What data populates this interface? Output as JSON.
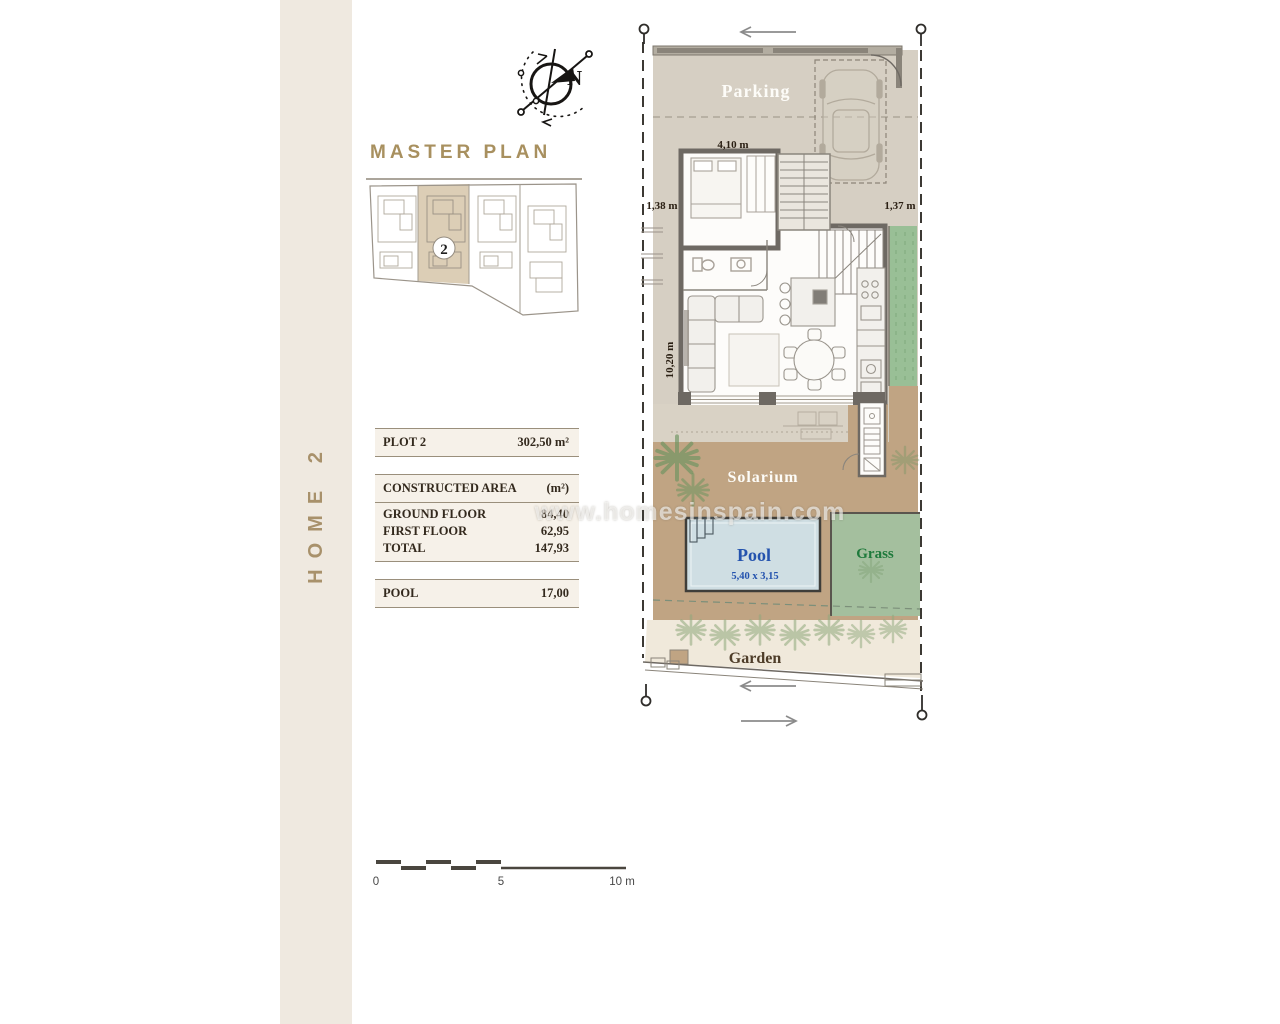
{
  "sidebar": {
    "label": "HOME 2"
  },
  "header": {
    "title": "MASTER PLAN"
  },
  "compass": {
    "north": "N"
  },
  "master_plan": {
    "badge": "2"
  },
  "table": {
    "plot": {
      "label": "PLOT 2",
      "value": "302,50 m²"
    },
    "area_header": {
      "label": "CONSTRUCTED AREA",
      "unit": "(m²)"
    },
    "rows": [
      {
        "label": "GROUND FLOOR",
        "value": "84,40"
      },
      {
        "label": "FIRST FLOOR",
        "value": "62,95"
      },
      {
        "label": "TOTAL",
        "value": "147,93"
      }
    ],
    "pool": {
      "label": "POOL",
      "value": "17,00"
    }
  },
  "plan": {
    "labels": {
      "parking": "Parking",
      "solarium": "Solarium",
      "pool": "Pool",
      "pool_size": "5,40 x 3,15",
      "grass": "Grass",
      "garden": "Garden"
    },
    "dimensions": {
      "top_width": "4,10 m",
      "left_setback": "1,38 m",
      "right_setback": "1,37 m",
      "side_height": "10,20 m"
    }
  },
  "watermark": {
    "text": "www.homesinspain.com"
  },
  "scale": {
    "start": "0",
    "mid": "5",
    "end": "10 m"
  },
  "colors": {
    "accent_gold": "#a8905f",
    "sidebar_bg": "#efe9e0",
    "parking_fill": "#d6cfc3",
    "solarium_fill": "#c0a483",
    "pool_fill": "#cfdee3",
    "pool_text": "#2453ae",
    "grass_fill": "#a4bf9e",
    "grass_text": "#1f7a3c",
    "garden_fill": "#f0e9db",
    "garden_text": "#4e3d29",
    "wall": "#6e6963"
  }
}
